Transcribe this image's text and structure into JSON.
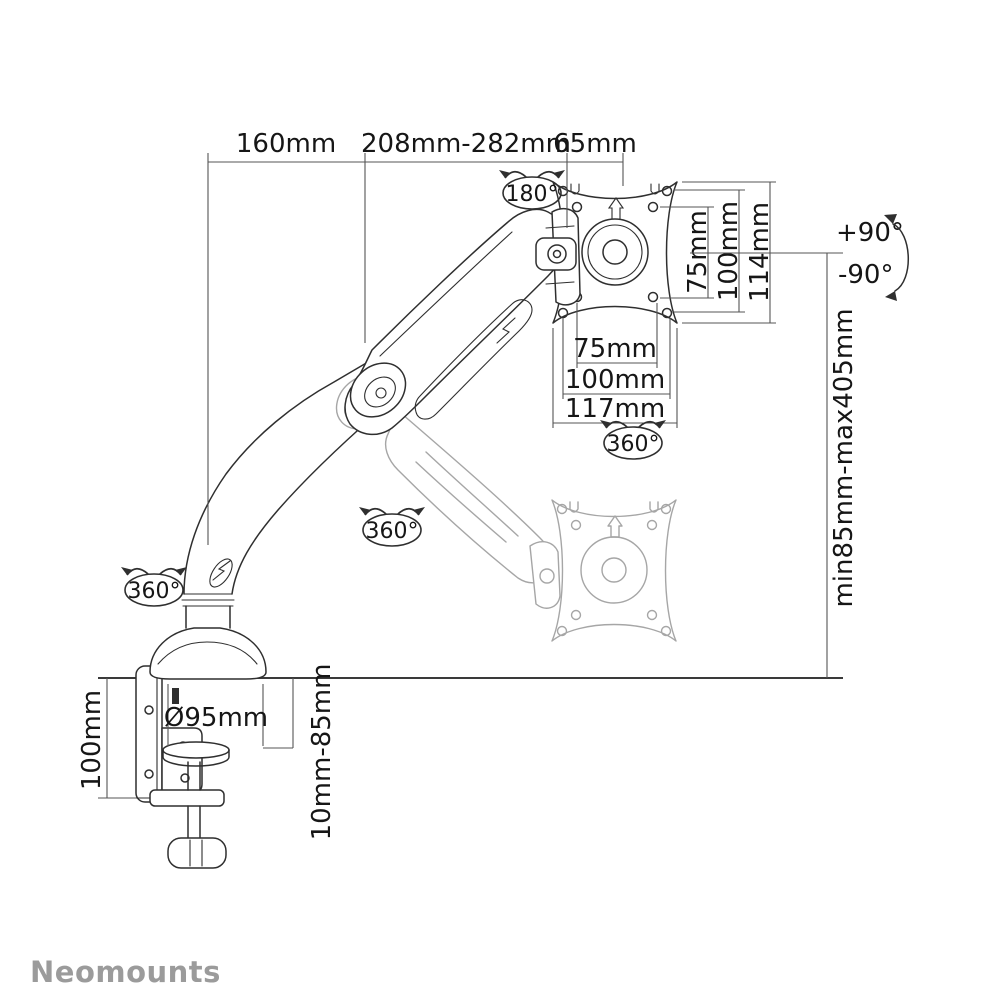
{
  "brand": {
    "logo": "Neomounts"
  },
  "colors": {
    "line": "#2f2f2f",
    "ghost_line": "#a6a6a6",
    "dimension_line": "#555555",
    "text": "#161616",
    "logo": "#9b9b9b",
    "background": "#ffffff"
  },
  "dimensions": {
    "top": {
      "left": "160mm",
      "middle": "208mm-282mm",
      "right": "65mm"
    },
    "vesa_vertical": {
      "inner": "75mm",
      "outer": "100mm",
      "plate": "114mm"
    },
    "vesa_horizontal": {
      "inner": "75mm",
      "outer": "100mm",
      "plate": "117mm"
    },
    "height_range": "min85mm-max405mm",
    "tilt": {
      "up": "+90°",
      "down": "-90°"
    },
    "rotation": {
      "head": "180°",
      "vesa": "360°",
      "arm": "360°",
      "base": "360°"
    },
    "base_diameter": "Ø95mm",
    "clamp_height": "100mm",
    "desk_thickness": "10mm-85mm"
  }
}
